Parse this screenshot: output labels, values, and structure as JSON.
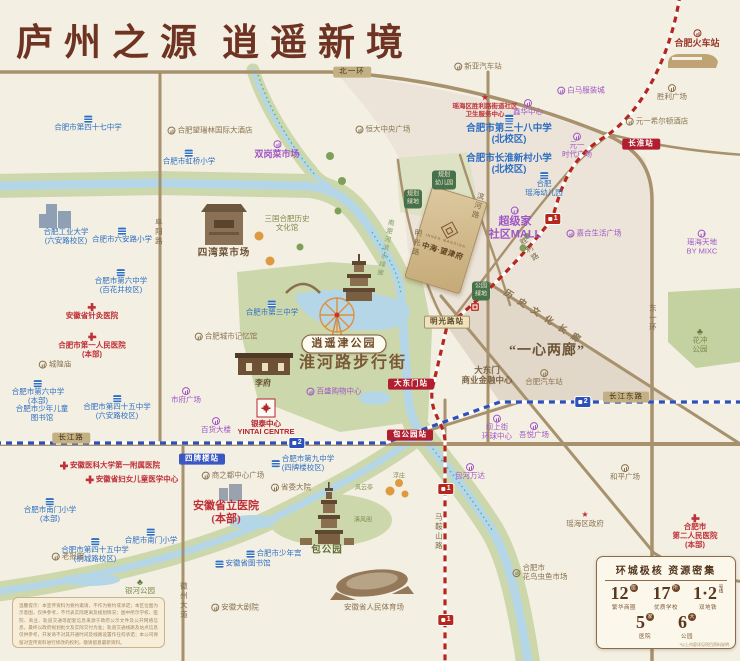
{
  "title": {
    "part1": "庐州之源",
    "part2": "逍遥新境"
  },
  "project": {
    "en": "INNER MANSION",
    "name": "中海·望津府"
  },
  "panel": {
    "title": "环城极核 资源密集",
    "stats": [
      {
        "num": "12",
        "unit": "座",
        "label": "繁华商圈"
      },
      {
        "num": "17",
        "unit": "所",
        "label": "优质学校"
      },
      {
        "num": "1·2",
        "unit": "号线",
        "label": "双地铁"
      },
      {
        "num": "5",
        "unit": "家",
        "label": "医院"
      },
      {
        "num": "6",
        "unit": "大",
        "label": "公园"
      }
    ],
    "note": "*以上内容详见项目资料说明"
  },
  "disclaimer": "温馨提示：本宣传资料为要约邀请，不作为要约或承诺；本区位图为示意图，仅供参考，不代表实际距离及规划情况；图中所示学校、医院、商业、轨道交通等配套信息来源于政府公示文件及公开网络信息，最终以政府规划批文及实际交付为准；轨道交通线路及站点信息仅供参考，开发商不对其开通时间及线路设置作任何承诺；本公司保留对宣传资料进行修改的权利，敬请留意最新资料。",
  "colors": {
    "metro1": "#b5271d",
    "metro2": "#2d51b8",
    "road": "#a8916d",
    "water": "#b5d6e6",
    "green": "#ccd8ac",
    "accent_red": "#b01e30",
    "purple": "#a055c5",
    "school_blue": "#2e6fc2",
    "hospital_red": "#bf3038",
    "brown": "#6e3322"
  },
  "labels": [
    [
      "合肥市第四十七中学",
      88,
      124,
      "school",
      "school",
      "top"
    ],
    [
      "合肥市虹桥小学",
      189,
      158,
      "school",
      "school",
      "top"
    ],
    [
      "合肥工业大学\n(六安路校区)",
      66,
      237,
      "school"
    ],
    [
      "合肥市六安路小学",
      122,
      236,
      "school",
      "school",
      "top"
    ],
    [
      "合肥市第三中学",
      272,
      309,
      "school",
      "school",
      "top"
    ],
    [
      "合肥市第六中学\n(百花井校区)",
      121,
      282,
      "school",
      "school",
      "top"
    ],
    [
      "合肥市第六中学\n(本部)",
      38,
      393,
      "school",
      "school",
      "top"
    ],
    [
      "合肥市第四十五中学\n(六安路校区)",
      117,
      408,
      "school",
      "school",
      "top"
    ],
    [
      "合肥市少年儿童\n图书馆",
      42,
      414,
      "school"
    ],
    [
      "合肥市第三十八中学\n(北校区)",
      509,
      130,
      "school big",
      "school",
      "top"
    ],
    [
      "合肥市长淮新村小学\n(北校区)",
      509,
      164,
      "school big"
    ],
    [
      "合肥\n瑶海幼儿园",
      544,
      185,
      "school",
      "school",
      "top"
    ],
    [
      "合肥市南门小学\n(本部)",
      50,
      511,
      "school",
      "school",
      "top"
    ],
    [
      "合肥市第四十五中学\n(桐城路校区)",
      95,
      551,
      "school",
      "school",
      "top"
    ],
    [
      "合肥市南门小学",
      151,
      537,
      "school",
      "school",
      "top"
    ],
    [
      "安徽省图书馆",
      243,
      564,
      "school",
      "school",
      "left"
    ],
    [
      "合肥市少年宫",
      274,
      554,
      "school",
      "school",
      "left"
    ],
    [
      "合肥市第九中学\n(四牌楼校区)",
      303,
      464,
      "school",
      "school",
      "left"
    ],
    [
      "安徽省针灸医院",
      92,
      312,
      "hospital",
      "cross",
      "top"
    ],
    [
      "合肥市第一人民医院\n(本部)",
      92,
      346,
      "hospital",
      "cross",
      "top"
    ],
    [
      "安徽医科大学第一附属医院",
      110,
      466,
      "hospital",
      "cross",
      "left"
    ],
    [
      "安徽省妇女儿童医学中心",
      132,
      480,
      "hospital",
      "cross",
      "left"
    ],
    [
      "合肥市\n第二人民医院\n(本部)",
      695,
      532,
      "hospital",
      "cross",
      "top"
    ],
    [
      "瑶海区胜利路街道社区\n卫生服务中心",
      485,
      106,
      "hospital small",
      "star",
      "top"
    ],
    [
      "安徽省立医院\n(本部)",
      226,
      513,
      "hospital big"
    ],
    [
      "白马服装城",
      581,
      91,
      "mall",
      "circ",
      "left"
    ],
    [
      "鑫华中心",
      528,
      108,
      "mall",
      "circ",
      "top"
    ],
    [
      "元一\n时代广场",
      577,
      146,
      "mall",
      "circ",
      "top"
    ],
    [
      "双岗菜市场",
      277,
      150,
      "mall bold",
      "circ",
      "top"
    ],
    [
      "超级家\n社区MALL",
      515,
      224,
      "mall big",
      "circ"
    ],
    [
      "嘉合生活广场",
      594,
      234,
      "mall",
      "circ",
      "left"
    ],
    [
      "瑶海天地\nBY MIXC",
      702,
      243,
      "mall",
      "circ",
      "top"
    ],
    [
      "市府广场",
      186,
      396,
      "mall",
      "circ",
      "top"
    ],
    [
      "百货大楼",
      216,
      426,
      "mall",
      "circ",
      "top"
    ],
    [
      "百盛购物中心",
      334,
      392,
      "mall",
      "circ",
      "left"
    ],
    [
      "坝上街\n环球中心",
      497,
      428,
      "mall",
      "circ",
      "top"
    ],
    [
      "吾悦广场",
      534,
      431,
      "mall",
      "circ",
      "top"
    ],
    [
      "包河万达",
      470,
      472,
      "mall",
      "circ",
      "top"
    ],
    [
      "新亚汽车站",
      478,
      67,
      "landmark",
      "circ",
      "left"
    ],
    [
      "胜利广场",
      672,
      93,
      "landmark",
      "circ",
      "top"
    ],
    [
      "元一希尔顿酒店",
      657,
      122,
      "landmark",
      "circ",
      "left"
    ],
    [
      "合肥望瑞林国际大酒店",
      210,
      131,
      "landmark",
      "circ",
      "left"
    ],
    [
      "恒大中央广场",
      383,
      130,
      "landmark",
      "circ",
      "left"
    ],
    [
      "合肥城市记忆馆",
      226,
      337,
      "landmark",
      "circ",
      "left"
    ],
    [
      "城隍庙",
      55,
      365,
      "landmark",
      "circ",
      "left"
    ],
    [
      "老报馆",
      68,
      557,
      "landmark",
      "circ",
      "left"
    ],
    [
      "安徽大剧院",
      235,
      608,
      "landmark",
      "circ",
      "left"
    ],
    [
      "商之都中心广场",
      233,
      476,
      "landmark",
      "circ",
      "left"
    ],
    [
      "省委大院",
      291,
      488,
      "landmark",
      "circ",
      "left"
    ],
    [
      "和平广场",
      625,
      473,
      "landmark",
      "circ",
      "top"
    ],
    [
      "合肥汽车站",
      544,
      378,
      "landmark",
      "circ",
      "top"
    ],
    [
      "瑶海区政府",
      585,
      520,
      "landmark",
      "star",
      "top"
    ],
    [
      "合肥市\n花鸟虫鱼市场",
      540,
      573,
      "landmark",
      "circ",
      "left"
    ],
    [
      "大东门\n商业金融中心",
      487,
      375,
      "landmark big-l"
    ],
    [
      "安徽省人民体育场",
      374,
      608,
      "landmark"
    ],
    [
      "合肥火车站",
      697,
      39,
      "railstation",
      "circ",
      "top"
    ],
    [
      "李府",
      263,
      383,
      "brown-serif"
    ],
    [
      "四湾菜市场",
      224,
      254,
      "brown-serif big-s"
    ],
    [
      "包公园",
      327,
      551,
      "park-bold"
    ],
    [
      "银泰中心\nYINTAI CENTRE",
      266,
      428,
      "redlogo"
    ],
    [
      "三国合肥历史\n文化馆",
      287,
      224,
      "parklbl"
    ],
    [
      "银河公园",
      140,
      587,
      "parklbl",
      "tree",
      "top"
    ],
    [
      "花冲\n公园",
      700,
      341,
      "parklbl",
      "tree",
      "top"
    ],
    [
      "清风阁",
      363,
      521,
      "parklbl tiny"
    ],
    [
      "浮庄",
      399,
      477,
      "parklbl tiny"
    ],
    [
      "风云亭",
      364,
      489,
      "parklbl tiny"
    ],
    [
      "长淮站",
      641,
      144,
      "st-red"
    ],
    [
      "大东门站",
      411,
      384,
      "st-red"
    ],
    [
      "包公园站",
      410,
      435,
      "st-red"
    ],
    [
      "明光路站",
      447,
      322,
      "st-tan"
    ],
    [
      "四牌楼站",
      202,
      459,
      "st-blue"
    ],
    [
      "北一环",
      352,
      72,
      "rd-badge"
    ],
    [
      "长江路",
      71,
      438,
      "rd-badge"
    ],
    [
      "长江东路",
      626,
      397,
      "rd-badge"
    ],
    [
      "阜阳路",
      158,
      232,
      "rd-vert"
    ],
    [
      "东一环",
      652,
      318,
      "rd-vert"
    ],
    [
      "徽州大道",
      183,
      601,
      "rd-vert"
    ],
    [
      "马鞍山路",
      438,
      532,
      "rd-vert"
    ],
    [
      "胜利路",
      529,
      250,
      "rd-vert",
      null,
      null,
      -35
    ],
    [
      "明光路",
      416,
      243,
      "rd-vert",
      null,
      null,
      8
    ],
    [
      "滨河路",
      477,
      206,
      "rd-vert",
      null,
      null,
      15
    ],
    [
      "1",
      553,
      219,
      "mb mb1"
    ],
    [
      "1",
      446,
      489,
      "mb mb1"
    ],
    [
      "1",
      446,
      620,
      "mb mb1"
    ],
    [
      "2",
      297,
      443,
      "mb mb2"
    ],
    [
      "2",
      583,
      402,
      "mb mb2"
    ],
    [
      "规划\n幼儿园",
      444,
      180,
      "green-box"
    ],
    [
      "规划\n绿地",
      413,
      199,
      "green-box"
    ],
    [
      "公园\n绿地",
      481,
      291,
      "green-box"
    ],
    [
      "逍遥津公园",
      344,
      344,
      "poi-badge"
    ],
    [
      "淮河路步行街",
      353,
      364,
      "street-big"
    ],
    [
      "“一心两廊”",
      547,
      352,
      "quote-big"
    ],
    [
      "历史文化长廊",
      545,
      318,
      "corridor",
      null,
      null,
      33
    ],
    [
      "南淝河滨水绿廊",
      384,
      248,
      "rivertext",
      null,
      null,
      12
    ],
    [
      "",
      475,
      307,
      "red-sq"
    ]
  ]
}
